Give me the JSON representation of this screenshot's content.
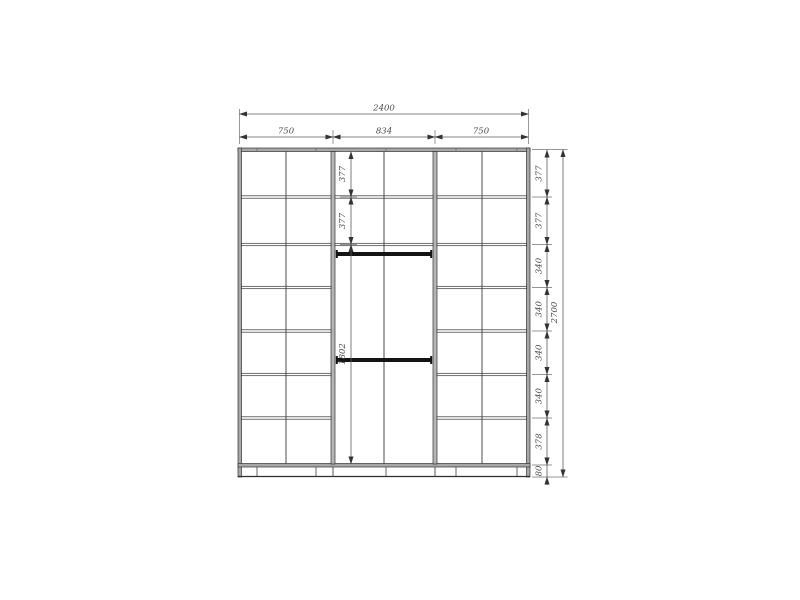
{
  "drawing": {
    "kind": "wardrobe-front-elevation",
    "colors": {
      "line": "#2f2f2f",
      "panel_fill": "#a8a8a8",
      "dim_line": "#5a5a5a",
      "dim_text": "#4a4a4a",
      "rail": "#141414",
      "background": "#ffffff"
    },
    "top_dims": {
      "total_width": "2400",
      "sections": [
        "750",
        "834",
        "750"
      ]
    },
    "right_dims": {
      "total_height": "2700",
      "chain": [
        "377",
        "377",
        "340",
        "340",
        "340",
        "340",
        "378",
        "80"
      ]
    },
    "middle_dims": {
      "chain": [
        "377",
        "377",
        "1802"
      ]
    }
  }
}
